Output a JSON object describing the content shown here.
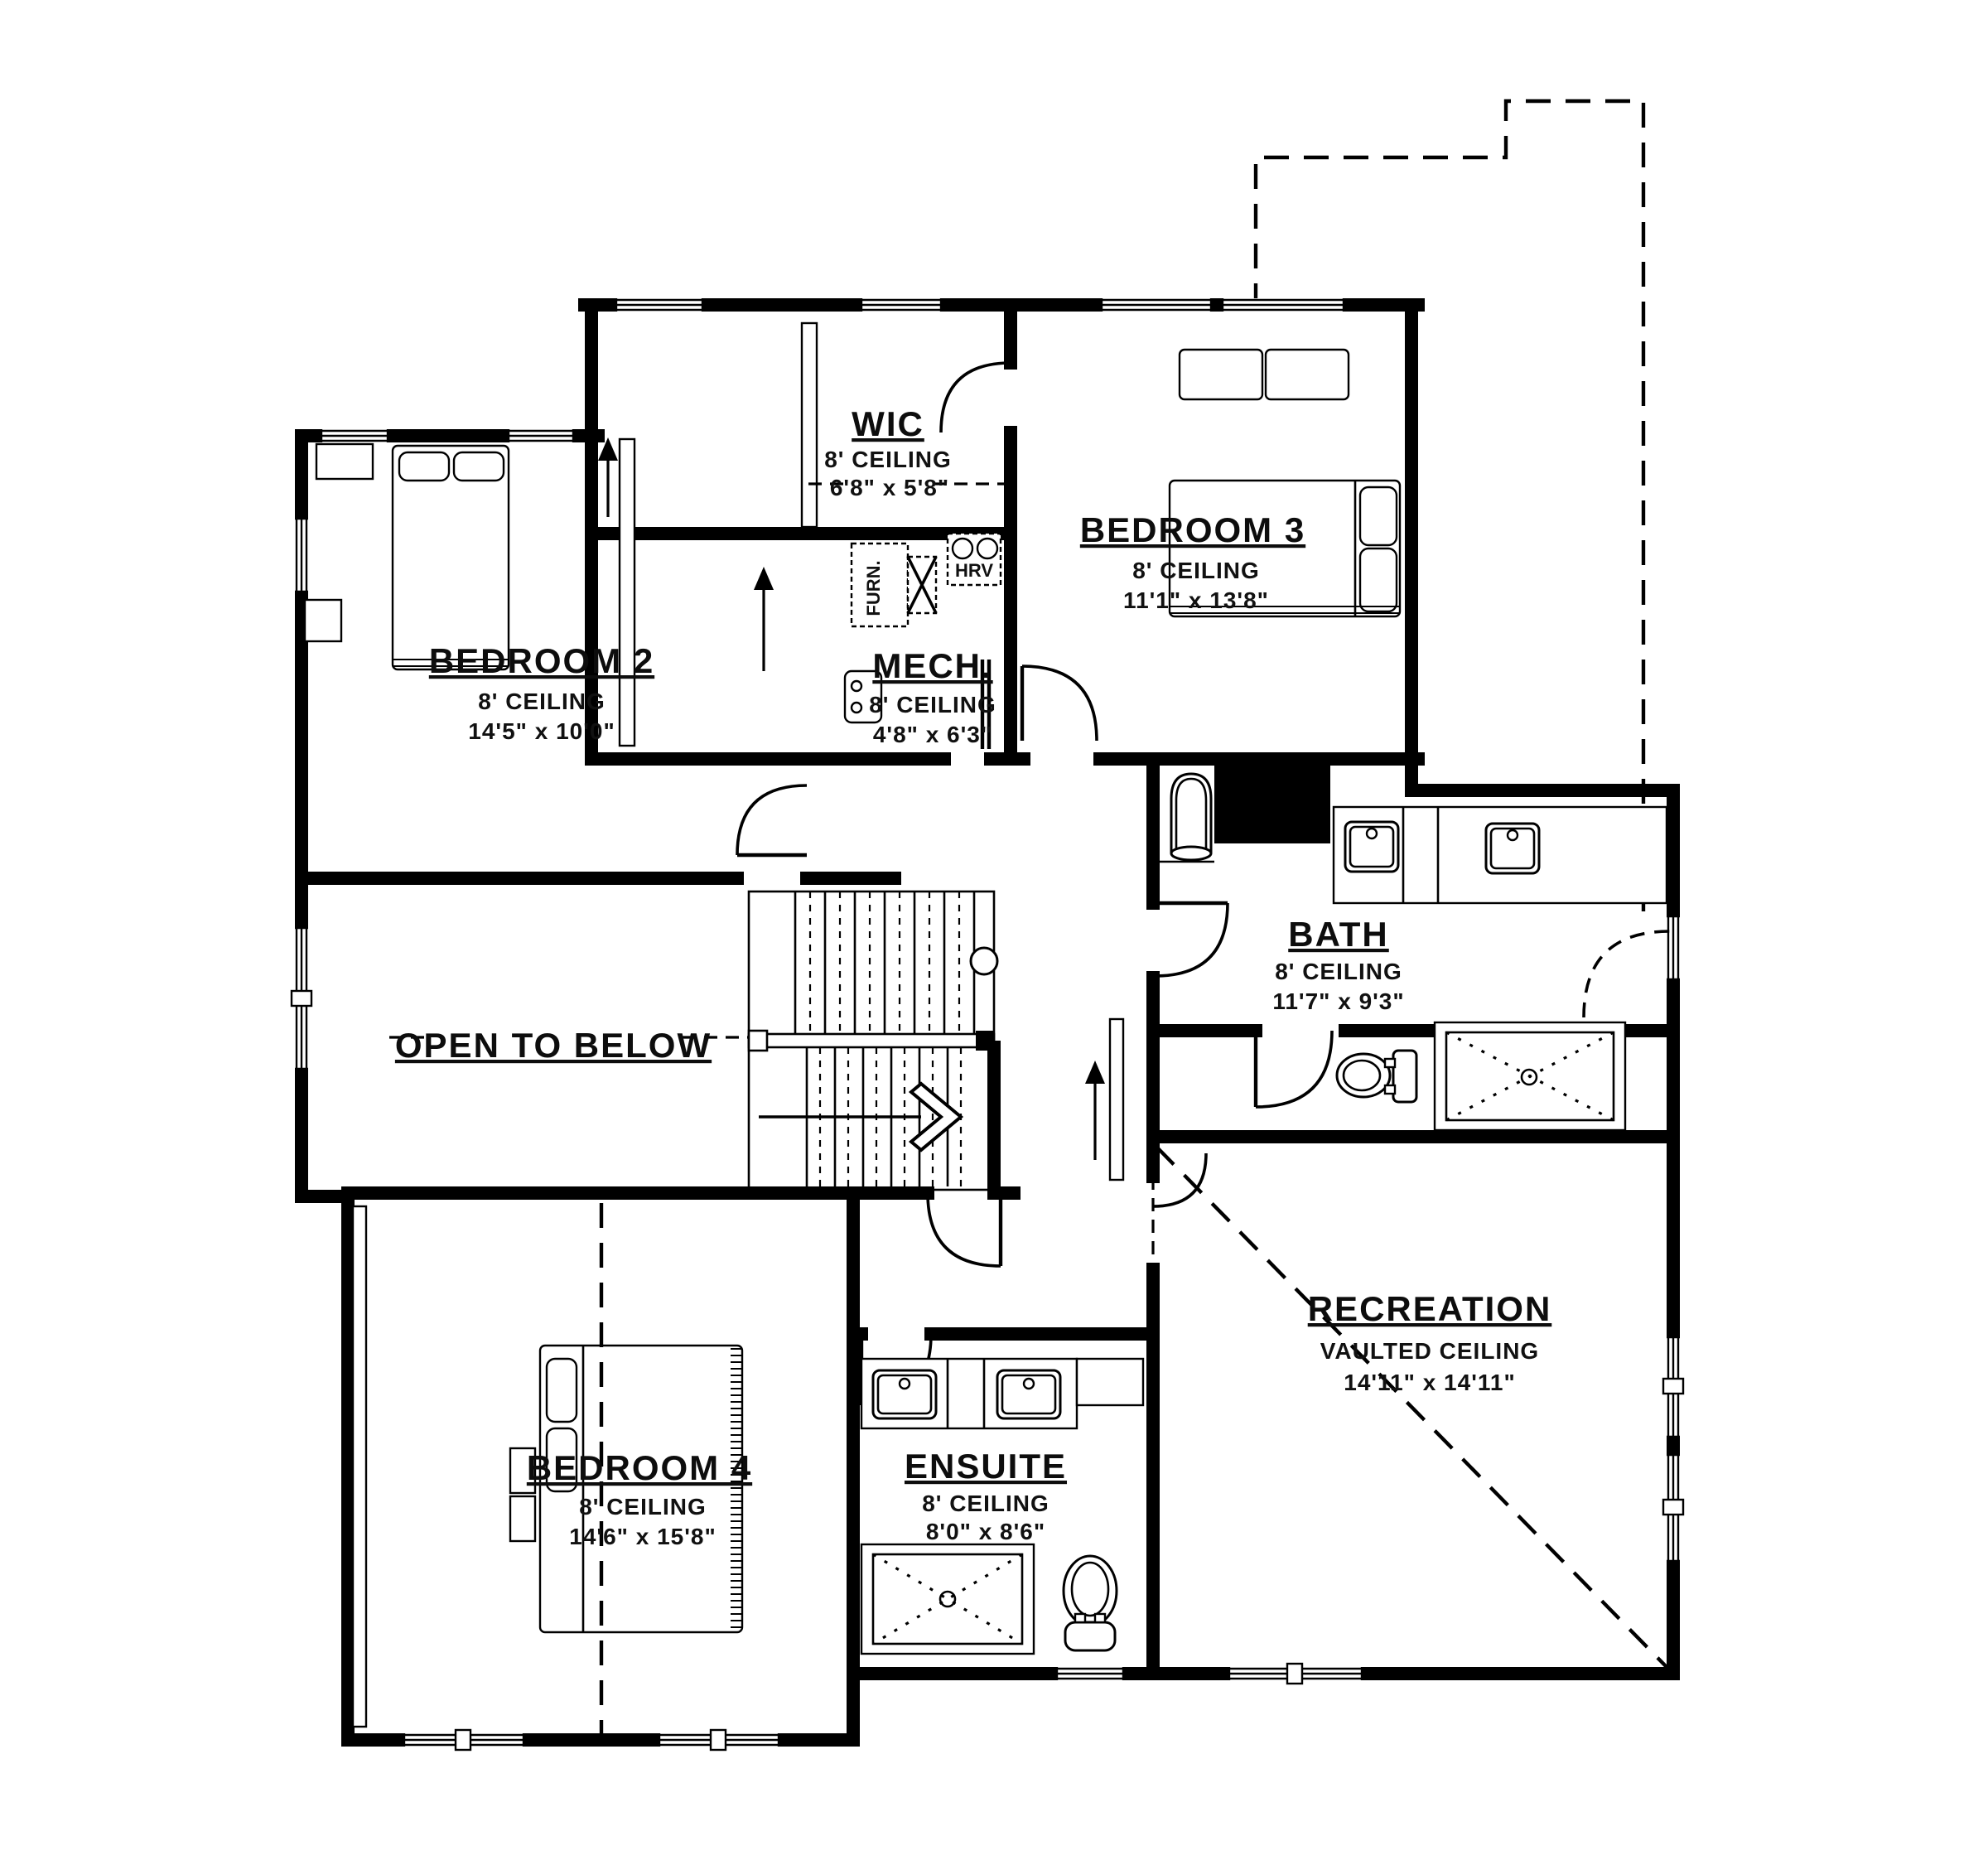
{
  "rooms": {
    "wic": {
      "name": "WIC",
      "ceiling": "8' CEILING",
      "dims": "6'8\" x 5'8\""
    },
    "bedroom3": {
      "name": "BEDROOM 3",
      "ceiling": "8' CEILING",
      "dims": "11'1\" x 13'8\""
    },
    "bedroom2": {
      "name": "BEDROOM 2",
      "ceiling": "8' CEILING",
      "dims": "14'5\" x 10'0\""
    },
    "mech": {
      "name": "MECH.",
      "ceiling": "8' CEILING",
      "dims": "4'8\" x 6'3\""
    },
    "bath": {
      "name": "BATH",
      "ceiling": "8' CEILING",
      "dims": "11'7\" x 9'3\""
    },
    "open_to_below": {
      "name": "OPEN TO BELOW"
    },
    "recreation": {
      "name": "RECREATION",
      "ceiling": "VAULTED CEILING",
      "dims": "14'11\" x 14'11\""
    },
    "bedroom4": {
      "name": "BEDROOM 4",
      "ceiling": "8' CEILING",
      "dims": "14'6\" x 15'8\""
    },
    "ensuite": {
      "name": "ENSUITE",
      "ceiling": "8' CEILING",
      "dims": "8'0\" x 8'6\""
    }
  },
  "equipment": {
    "furnace": "FURN.",
    "hrv": "HRV"
  },
  "colors": {
    "wall": "#000000",
    "background": "#ffffff",
    "text": "#111111"
  }
}
